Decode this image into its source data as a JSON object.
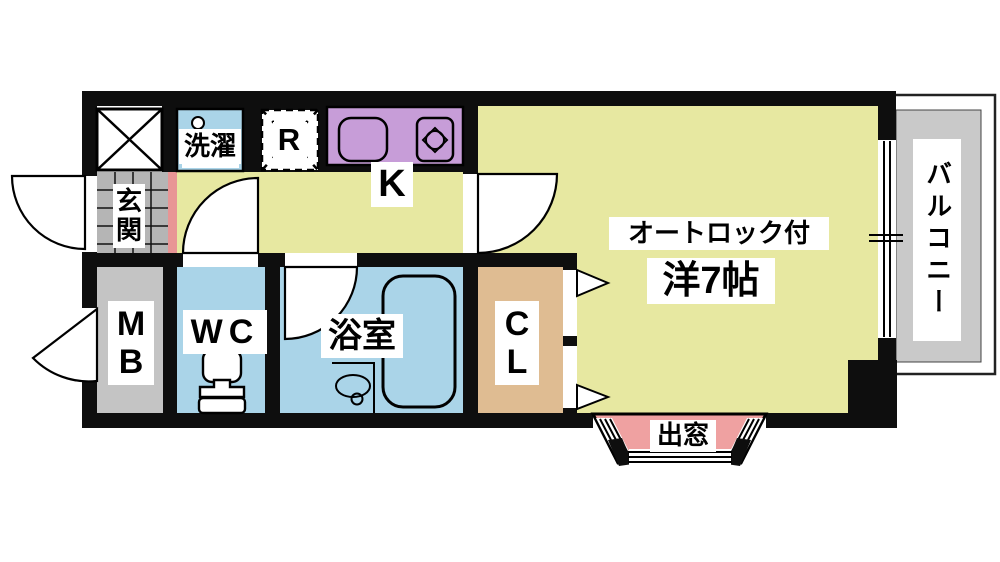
{
  "plan": {
    "type": "apartment-floor-plan",
    "rooms": {
      "main_room": {
        "name_label": "洋7帖",
        "feature_label": "オートロック付"
      },
      "kitchen": {
        "label": "K"
      },
      "laundry": {
        "label": "洗濯"
      },
      "refrigerator": {
        "label": "R"
      },
      "entrance": {
        "label": "玄\n関"
      },
      "meter_box": {
        "label": "M\nB"
      },
      "toilet": {
        "label": "WC"
      },
      "bathroom": {
        "label": "浴室"
      },
      "closet": {
        "label": "C\nL"
      },
      "balcony": {
        "label": "バルコニー"
      },
      "bay_window": {
        "label": "出窓"
      }
    },
    "colors": {
      "wall": "#0e0e0e",
      "floor_yellow": "#e7e8a1",
      "water_blue": "#aad4e8",
      "counter_purple": "#c79dd8",
      "closet_tan": "#dfbc92",
      "bay_pink": "#efa1a1",
      "step_pink": "#e89595",
      "tile_gray": "#b5b5b5",
      "mb_gray": "#c4c4c4",
      "balcony_gray": "#c9c9c9",
      "paper_white": "#ffffff"
    }
  }
}
